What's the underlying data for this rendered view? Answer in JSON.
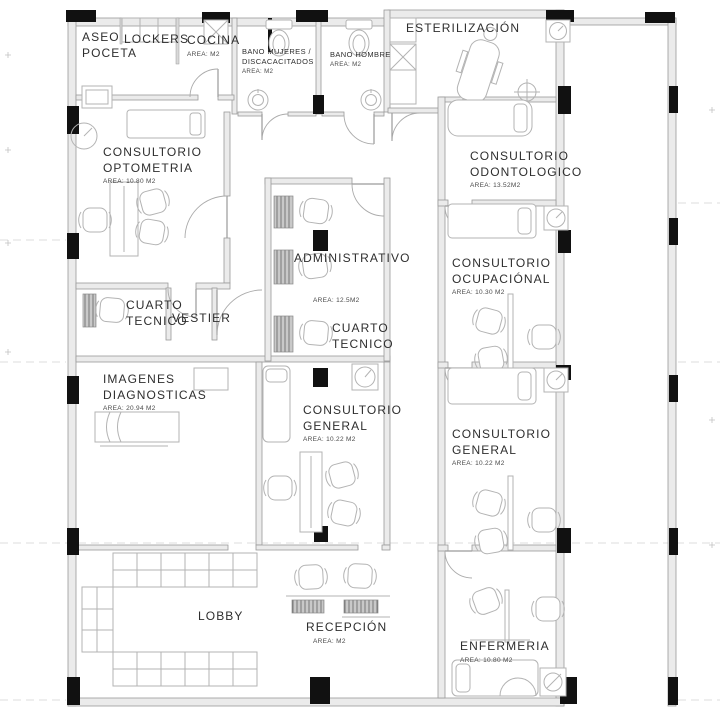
{
  "drawing": {
    "type": "architectural-floor-plan",
    "colors": {
      "wall_fill": "#ebebeb",
      "wall_line": "#9a9a9a",
      "column": "#111111",
      "text": "#2e2e2e",
      "furniture_line": "#b3b3b3"
    }
  },
  "rooms": {
    "aseo": {
      "name": "ASEO\nPOCETA",
      "area": ""
    },
    "lockers": {
      "name": "LOCKERS",
      "area": ""
    },
    "cocina": {
      "name": "COCINA",
      "area": "AREA: M2"
    },
    "bano_mujeres": {
      "name": "BANO  MUJERES /\nDISCACACITADOS",
      "area": "AREA: M2"
    },
    "bano_hombre": {
      "name": "BANO HOMBRE",
      "area": "AREA: M2"
    },
    "esterilizacion": {
      "name": "ESTERILIZACIÓN",
      "area": ""
    },
    "optometria": {
      "name": "CONSULTORIO\nOPTOMETRIA",
      "area": "AREA: 10.80 M2"
    },
    "odontologico": {
      "name": "CONSULTORIO\nODONTOLOGICO",
      "area": "AREA: 13.52M2"
    },
    "administrativo": {
      "name": "ADMINISTRATIVO",
      "area": "AREA: 12.5M2"
    },
    "cuarto_tecnico_izq": {
      "name": "CUARTO\nTECNICO",
      "area": ""
    },
    "vestier": {
      "name": "VESTIER",
      "area": ""
    },
    "cuarto_tecnico_centro": {
      "name": "CUARTO\nTECNICO",
      "area": ""
    },
    "ocupacional": {
      "name": "CONSULTORIO\nOCUPACIÓNAL",
      "area": "AREA: 10.30 M2"
    },
    "imagenes": {
      "name": "IMAGENES\nDIAGNOSTICAS",
      "area": "AREA: 20.94 M2"
    },
    "general_centro": {
      "name": "CONSULTORIO\nGENERAL",
      "area": "AREA: 10.22 M2"
    },
    "general_der": {
      "name": "CONSULTORIO\nGENERAL",
      "area": "AREA: 10.22 M2"
    },
    "lobby": {
      "name": "LOBBY",
      "area": ""
    },
    "recepcion": {
      "name": "RECEPCIÓN",
      "area": "AREA: M2"
    },
    "enfermeria": {
      "name": "ENFERMERIA",
      "area": "AREA: 10.80 M2"
    }
  }
}
